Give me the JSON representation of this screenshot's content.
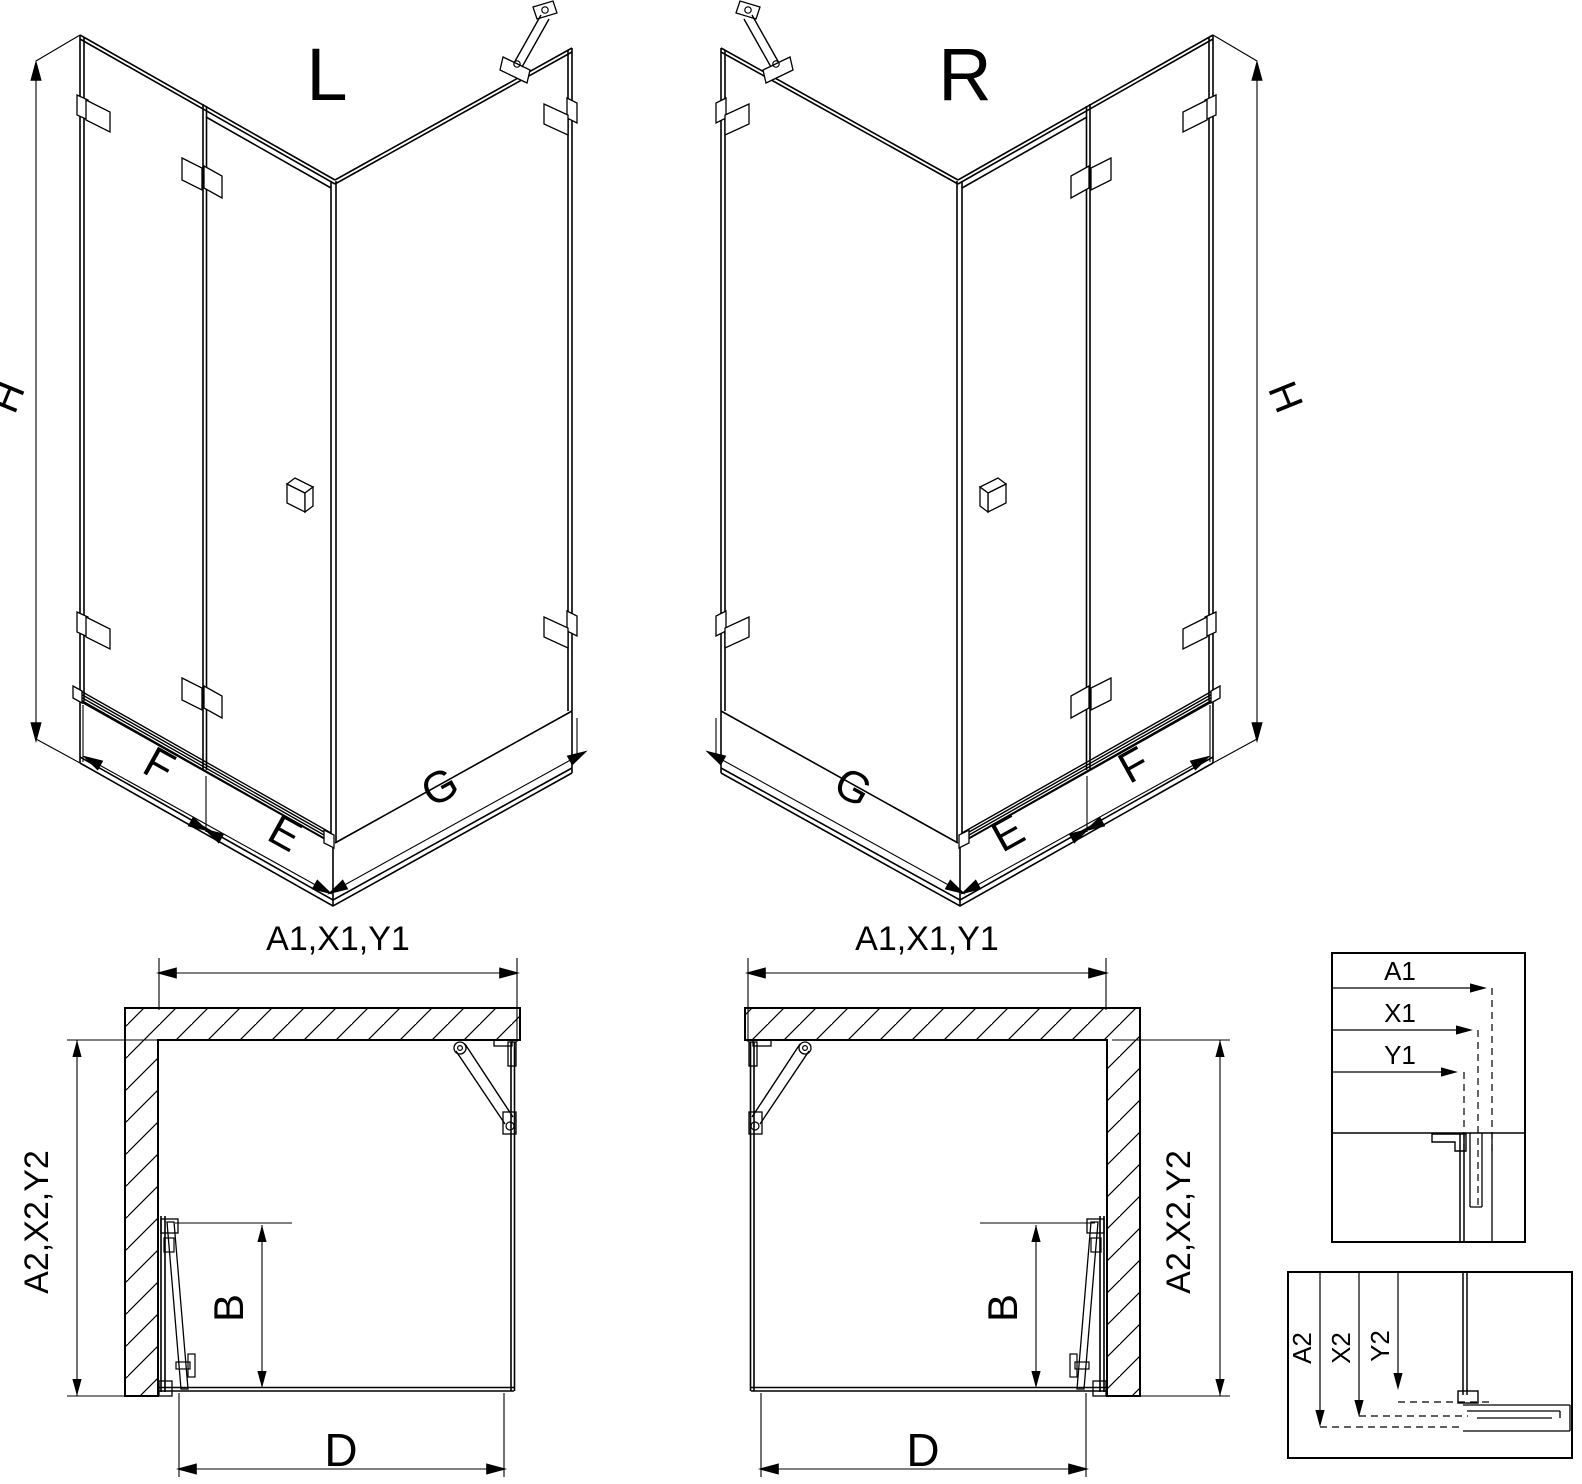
{
  "drawing": {
    "title": "shower-enclosure-technical-drawing",
    "variants": {
      "left": "L",
      "right": "R"
    },
    "iso_dims": {
      "height": "H",
      "fixed_panel": "F",
      "door_panel": "E",
      "side_panel": "G"
    },
    "plan_dims": {
      "top": "A1,X1,Y1",
      "side": "A2,X2,Y2",
      "door": "B",
      "bottom": "D"
    },
    "detail_top": {
      "a1": "A1",
      "x1": "X1",
      "y1": "Y1"
    },
    "detail_bottom": {
      "a2": "A2",
      "x2": "X2",
      "y2": "Y2"
    },
    "colors": {
      "line": "#000000",
      "background": "#ffffff"
    }
  }
}
